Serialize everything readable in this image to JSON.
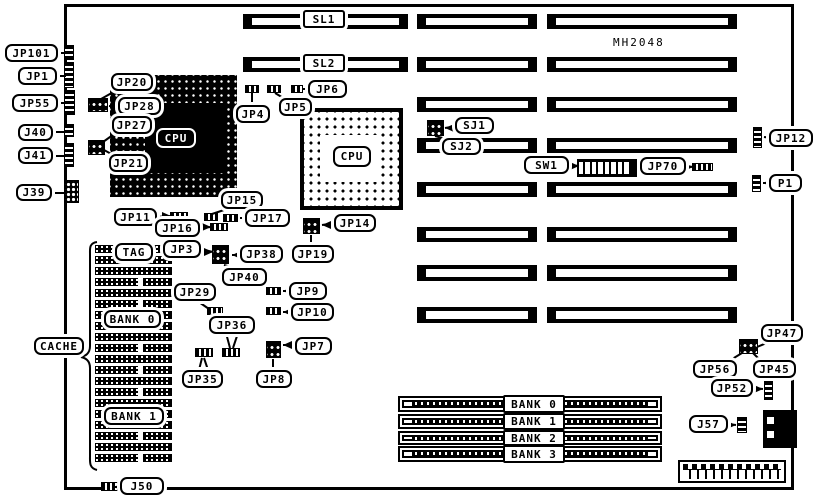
{
  "diagram": {
    "model": "MH2048",
    "cache_row_count": 20
  },
  "labels": {
    "jp101": "JP101",
    "jp1": "JP1",
    "jp55": "JP55",
    "j40": "J40",
    "j41": "J41",
    "j39": "J39",
    "jp20": "JP20",
    "jp28": "JP28",
    "jp27": "JP27",
    "jp21": "JP21",
    "jp4": "JP4",
    "jp5": "JP5",
    "jp6": "JP6",
    "sl1": "SL1",
    "sl2": "SL2",
    "sj1": "SJ1",
    "sj2": "SJ2",
    "sw1": "SW1",
    "jp70": "JP70",
    "jp12": "JP12",
    "p1": "P1",
    "jp15": "JP15",
    "jp11": "JP11",
    "jp16": "JP16",
    "jp17": "JP17",
    "jp14": "JP14",
    "jp19": "JP19",
    "tag": "TAG",
    "jp3": "JP3",
    "jp38": "JP38",
    "jp40": "JP40",
    "jp29": "JP29",
    "jp9": "JP9",
    "jp10": "JP10",
    "jp36": "JP36",
    "jp35": "JP35",
    "jp7": "JP7",
    "jp8": "JP8",
    "cache": "CACHE",
    "cache_bank0": "BANK 0",
    "cache_bank1": "BANK 1",
    "jp47": "JP47",
    "jp56": "JP56",
    "jp45": "JP45",
    "jp52": "JP52",
    "j57": "J57",
    "j50": "J50",
    "cpu1": "CPU",
    "cpu2": "CPU"
  },
  "simm_banks": [
    "BANK 0",
    "BANK 1",
    "BANK 2",
    "BANK 3"
  ],
  "colors": {
    "ink": "#000000",
    "paper": "#ffffff"
  }
}
